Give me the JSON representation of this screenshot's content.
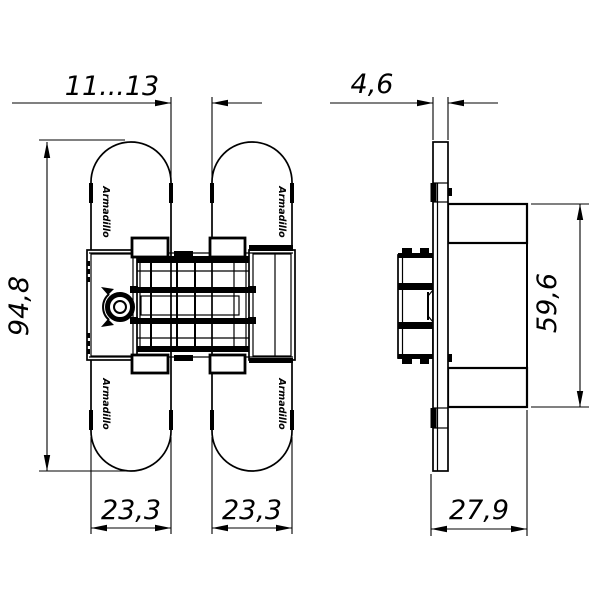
{
  "drawing": {
    "brand_label": "Armadillo",
    "colors": {
      "line": "#000000",
      "background": "#ffffff"
    },
    "dims": {
      "gap_range": "11...13",
      "plate_thickness": "4,6",
      "overall_height": "94,8",
      "cup_height": "59,6",
      "left_plate_width": "23,3",
      "right_plate_width": "23,3",
      "cup_depth": "27,9"
    }
  }
}
